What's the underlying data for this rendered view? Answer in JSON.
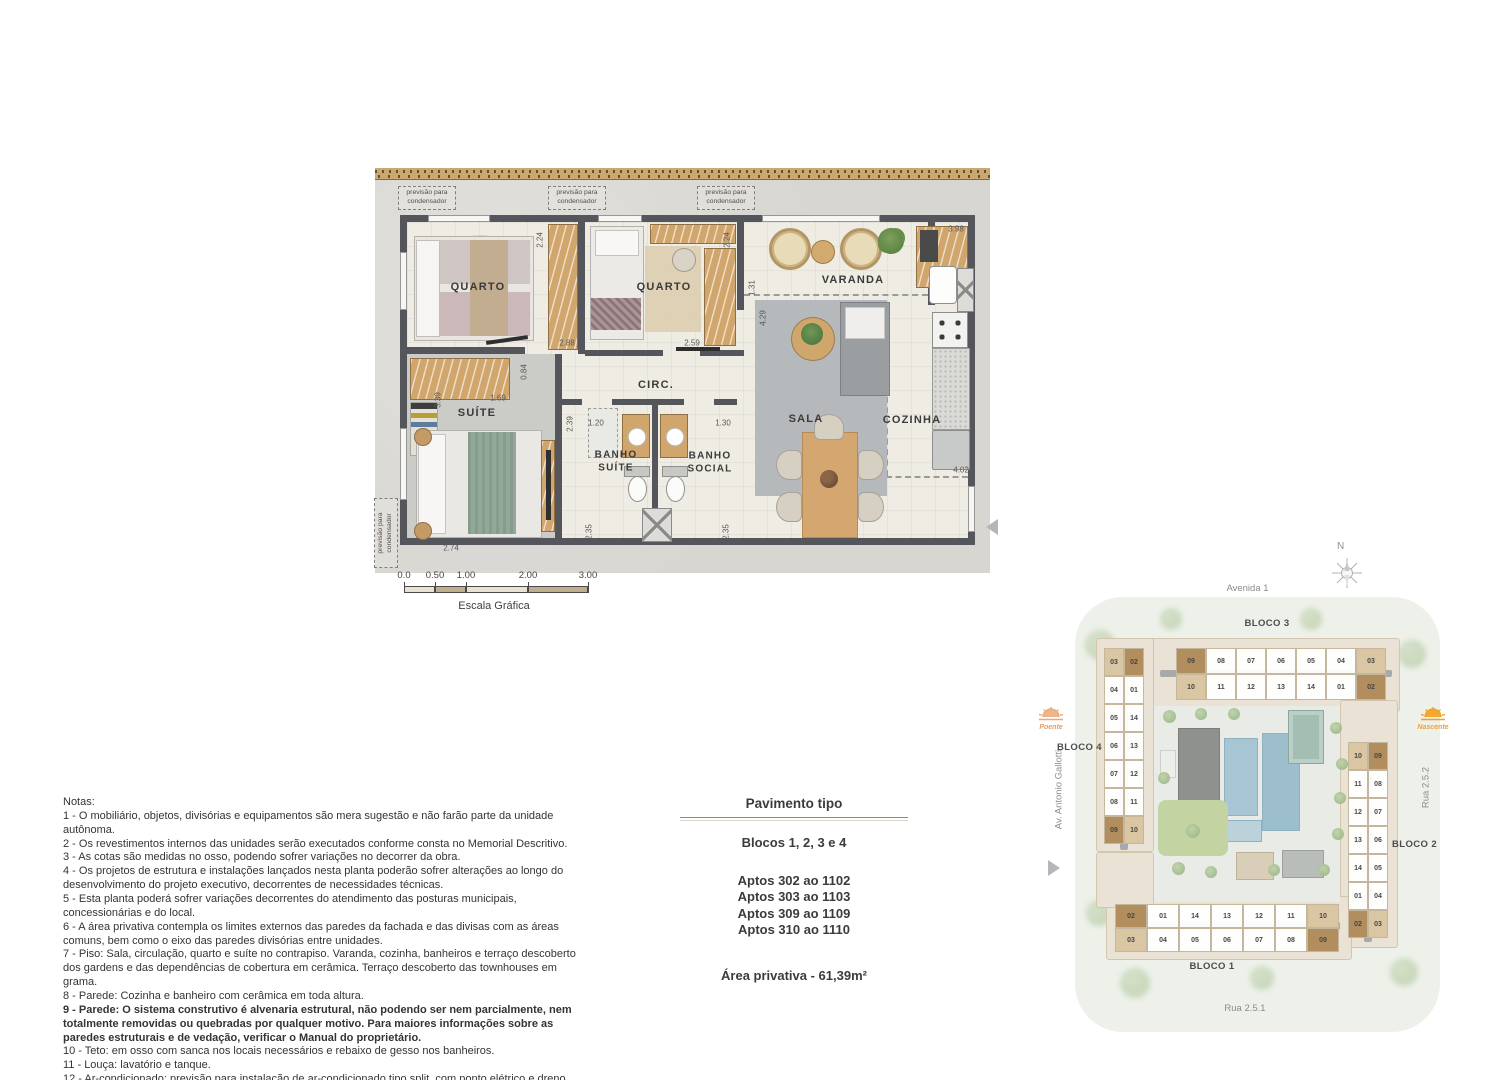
{
  "floor_plan": {
    "condenser_note": "previsão para condensador",
    "rooms": {
      "quarto1": "QUARTO",
      "quarto2": "QUARTO",
      "varanda": "VARANDA",
      "suite": "SUÍTE",
      "circ": "CIRC.",
      "sala": "SALA",
      "cozinha": "COZINHA",
      "banho_suite": "BANHO SUÍTE",
      "banho_social": "BANHO SOCIAL"
    },
    "dims": {
      "q1_width": "2.24",
      "q2_width": "2.24",
      "varanda_len": "3.98",
      "varanda_depth": "1.31",
      "sala_width": "4.29",
      "q1_bottom": "2.88",
      "q2_bottom": "2.59",
      "circ_height": "0.84",
      "suite_closet": "1.69",
      "suite_height": "3.39",
      "hall_depth": "2.39",
      "banho_suite_w": "1.20",
      "banho_social_w": "1.30",
      "banho_suite_h": "2.35",
      "banho_social_h": "2.35",
      "suite_width": "2.74",
      "cozinha_len": "4.02"
    }
  },
  "scale_bar": {
    "ticks": [
      "0.0",
      "0.50",
      "1.00",
      "2.00",
      "3.00"
    ],
    "label": "Escala Gráfica"
  },
  "notes": {
    "title": "Notas:",
    "items": [
      "1 - O mobiliário, objetos, divisórias e equipamentos são mera sugestão e não farão parte da unidade autônoma.",
      "2 - Os revestimentos internos das unidades serão executados conforme consta no Memorial Descritivo.",
      "3 - As cotas são medidas no osso, podendo sofrer variações no decorrer da obra.",
      "4 - Os projetos de estrutura e instalações lançados nesta planta poderão sofrer alterações ao longo do desenvolvimento do projeto executivo, decorrentes de necessidades técnicas.",
      "5 - Esta planta poderá sofrer variações decorrentes do atendimento das posturas municipais, concessionárias e do local.",
      "6 - A área privativa contempla os limites externos das paredes da fachada e das divisas com as áreas comuns, bem como o eixo das paredes divisórias entre unidades.",
      "7 - Piso: Sala, circulação, quarto e suíte no contrapiso. Varanda, cozinha, banheiros e terraço descoberto dos gardens e das dependências de cobertura em cerâmica. Terraço descoberto das townhouses em grama.",
      "8 - Parede: Cozinha e banheiro com cerâmica em toda altura.",
      "9 - Parede: O sistema construtivo é alvenaria estrutural, não podendo ser nem parcialmente, nem totalmente removidas ou quebradas por qualquer motivo. Para maiores informações sobre as paredes estruturais e de vedação, verificar o Manual do proprietário.",
      "10 - Teto: em osso com sanca nos locais necessários e rebaixo de gesso nos banheiros.",
      "11 - Louça: lavatório e tanque.",
      "12 - Ar-condicionado: previsão para instalação de ar-condicionado tipo split, com ponto elétrico e dreno, que deverá ser instalado conforme projeto. A previsão das condensadoras irá variar conforme projeto de fachada."
    ]
  },
  "info_box": {
    "title": "Pavimento tipo",
    "blocks": "Blocos 1, 2, 3 e 4",
    "aptos": [
      "Aptos 302 ao 1102",
      "Aptos 303 ao 1103",
      "Aptos 309 ao 1109",
      "Aptos 310 ao 1110"
    ],
    "area": "Área privativa - 61,39m²"
  },
  "site_plan": {
    "streets": {
      "top": "Avenida 1",
      "right": "Rua 2.5.2",
      "bottom": "Rua 2.5.1",
      "left": "Av. Antonio Gallotti"
    },
    "compass_label": "N",
    "sun_west": "Poente",
    "sun_east": "Nascente",
    "blocks": {
      "bloco3": {
        "label": "BLOCO 3",
        "row_top": [
          {
            "n": "09",
            "h": "dark"
          },
          {
            "n": "08"
          },
          {
            "n": "07"
          },
          {
            "n": "06"
          },
          {
            "n": "05"
          },
          {
            "n": "04"
          },
          {
            "n": "03",
            "h": "light"
          }
        ],
        "row_bottom": [
          {
            "n": "10",
            "h": "light"
          },
          {
            "n": "11"
          },
          {
            "n": "12"
          },
          {
            "n": "13"
          },
          {
            "n": "14"
          },
          {
            "n": "01"
          },
          {
            "n": "02",
            "h": "dark"
          }
        ]
      },
      "bloco4": {
        "label": "BLOCO 4",
        "col_left": [
          {
            "n": "03",
            "h": "light"
          },
          {
            "n": "04"
          },
          {
            "n": "05"
          },
          {
            "n": "06"
          },
          {
            "n": "07"
          },
          {
            "n": "08"
          },
          {
            "n": "09",
            "h": "dark"
          }
        ],
        "col_right": [
          {
            "n": "02",
            "h": "dark"
          },
          {
            "n": "01"
          },
          {
            "n": "14"
          },
          {
            "n": "13"
          },
          {
            "n": "12"
          },
          {
            "n": "11"
          },
          {
            "n": "10",
            "h": "light"
          }
        ]
      },
      "bloco2": {
        "label": "BLOCO 2",
        "col_left": [
          {
            "n": "10",
            "h": "light"
          },
          {
            "n": "11"
          },
          {
            "n": "12"
          },
          {
            "n": "13"
          },
          {
            "n": "14"
          },
          {
            "n": "01"
          },
          {
            "n": "02",
            "h": "dark"
          }
        ],
        "col_right": [
          {
            "n": "09",
            "h": "dark"
          },
          {
            "n": "08"
          },
          {
            "n": "07"
          },
          {
            "n": "06"
          },
          {
            "n": "05"
          },
          {
            "n": "04"
          },
          {
            "n": "03",
            "h": "light"
          }
        ]
      },
      "bloco1": {
        "label": "BLOCO 1",
        "row_top": [
          {
            "n": "02",
            "h": "dark"
          },
          {
            "n": "01"
          },
          {
            "n": "14"
          },
          {
            "n": "13"
          },
          {
            "n": "12"
          },
          {
            "n": "11"
          },
          {
            "n": "10",
            "h": "light"
          }
        ],
        "row_bottom": [
          {
            "n": "03",
            "h": "light"
          },
          {
            "n": "04"
          },
          {
            "n": "05"
          },
          {
            "n": "06"
          },
          {
            "n": "07"
          },
          {
            "n": "08"
          },
          {
            "n": "09",
            "h": "dark"
          }
        ]
      }
    }
  },
  "colors": {
    "wall": "#55565b",
    "wood": "#d1a66d",
    "highlight_dark": "#b28d5e",
    "highlight_light": "#dac6a3",
    "sun_nascente": "#f2a01e",
    "sun_poente": "#e9a877",
    "site_bg": "#eef1ea",
    "pool": "#a7c5d2"
  }
}
